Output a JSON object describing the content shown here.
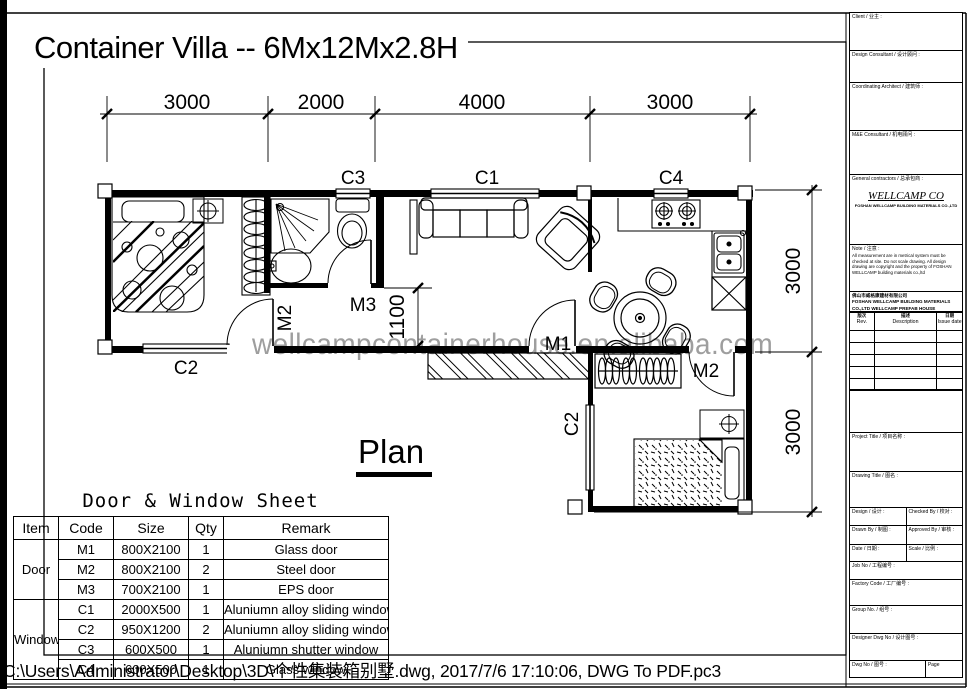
{
  "page": {
    "title": "Container Villa -- 6Mx12Mx2.8H",
    "plan_caption": "Plan",
    "watermark": "wellcampcontainerhouse.en.alibaba.com",
    "file_path_bar": "C:\\Users\\Administrator\\Desktop\\3D\\个性集装箱别墅.dwg, 2017/7/6 17:10:06, DWG To PDF.pc3"
  },
  "plan": {
    "dimensions": {
      "top": [
        "3000",
        "2000",
        "4000",
        "3000"
      ],
      "right": [
        "3000",
        "3000"
      ],
      "interior": "1100"
    },
    "labels": {
      "c1": "C1",
      "c2_bottom": "C2",
      "c2_side": "C2",
      "c3": "C3",
      "c4": "C4",
      "m1": "M1",
      "m2_bedroom": "M2",
      "m2_bedroom2": "M2",
      "m3": "M3"
    }
  },
  "sheet_table": {
    "title": "Door & Window Sheet",
    "headers": [
      "Item",
      "Code",
      "Size",
      "Qty",
      "Remark"
    ],
    "groups": [
      {
        "item": "Door",
        "rows": [
          [
            "M1",
            "800X2100",
            "1",
            "Glass door"
          ],
          [
            "M2",
            "800X2100",
            "2",
            "Steel door"
          ],
          [
            "M3",
            "700X2100",
            "1",
            "EPS door"
          ]
        ]
      },
      {
        "item": "Window",
        "rows": [
          [
            "C1",
            "2000X500",
            "1",
            "Aluniumn alloy sliding window"
          ],
          [
            "C2",
            "950X1200",
            "2",
            "Aluniumn alloy sliding window"
          ],
          [
            "C3",
            "600X500",
            "1",
            "Aluniumn shutter window"
          ],
          [
            "C4",
            "600X500",
            "1",
            "Glass window"
          ]
        ]
      }
    ]
  },
  "title_block": {
    "sections": {
      "client": "Client / 业主 :",
      "design_consultant": "Design Consultant / 设计顾问 :",
      "coordinating_architect": "Coordinating Architect / 建筑师 :",
      "me_consultant": "M&E Consultant / 机电顾问 :",
      "general_contractors": "General contractors / 总承包商 :"
    },
    "company": {
      "logo_text": "WELLCAMP CO",
      "name_line": "FOSHAN WELLCAMP BUILDING MATERIALS CO.,LTD"
    },
    "note": {
      "title": "Note / 注意 :",
      "body": "All measurement are in metrical system must be checked at site. Do not scale drawing. All design drawing are copyright and the property of FOSHAN WELLCAMP building materials co.,ltd"
    },
    "address_lines": [
      "佛山市威格康建材有限公司",
      "FOSHAN WELLCAMP BUILDING MATERIALS CO.,LTD",
      "WELLCAMP PREFAB HOUSE"
    ],
    "revision_table": {
      "columns": [
        {
          "zh": "版次",
          "en": "Rev."
        },
        {
          "zh": "描述",
          "en": "Description"
        },
        {
          "zh": "日期",
          "en": "Issue date"
        }
      ]
    },
    "fields": {
      "project_title": "Project Title / 项目名称 :",
      "drawing_title": "Drawing Title / 图名 :",
      "design": "Design / 设计 :",
      "checked_by": "Checked By / 校对 :",
      "drawn_by": "Drawn By / 制图 :",
      "approved_by": "Approved By / 审核 :",
      "date": "Date / 日期 :",
      "scale": "Scale / 比例 :",
      "job_no": "Job No / 工程编号 :",
      "factory_code": "Factory Code / 工厂编号 :",
      "group_no": "Group No. / 组号 :",
      "designer_dwg_no": "Designer Dwg No / 设计图号 :",
      "dwg_no": "Dwg No / 图号 :",
      "page": "Page"
    }
  }
}
